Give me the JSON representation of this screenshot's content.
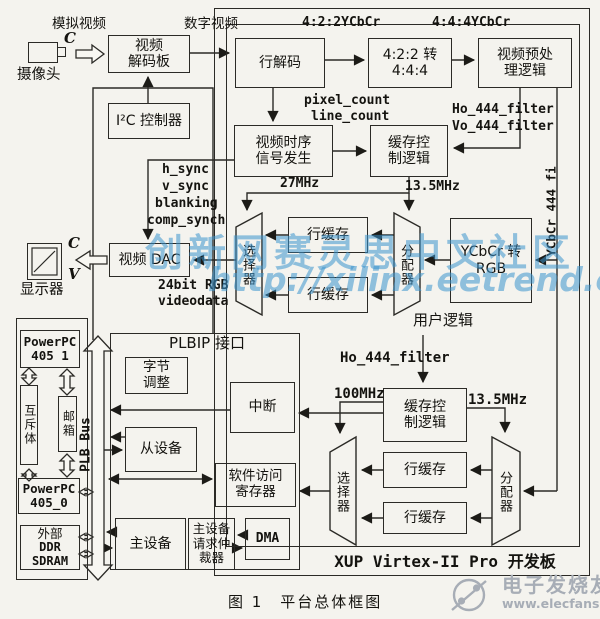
{
  "peripherals": {
    "camera_label": "摄像头",
    "analog_video": "模拟视频",
    "cam_c": "C",
    "decoder_l1": "视频",
    "decoder_l2": "解码板",
    "digital_video": "数字视频",
    "i2c": "I²C 控制器",
    "dac": "视频 DAC",
    "display": "显示器",
    "disp_c": "C",
    "disp_v": "V"
  },
  "signals": {
    "ycbcr422": "4:2:2YCbCr",
    "ycbcr444": "4:4:4YCbCr",
    "pixel_count": "pixel_count",
    "line_count": "line_count",
    "ho444_u": "Ho_444_filter",
    "vo444": "Vo_444_filter",
    "mhz27": "27MHz",
    "mhz135_u": "13.5MHz",
    "hsync": "h_sync",
    "vsync": "v_sync",
    "blanking": "blanking",
    "compsynch": "comp_synch",
    "rgb24": "24bit RGB",
    "videodata": "videodata",
    "ycbcr444fi": "YCbCr 444 fi",
    "ho444_l": "Ho_444_filter",
    "mhz100": "100MHz",
    "mhz135_l": "13.5MHz",
    "plb_bus": "PLB Bus"
  },
  "fpga": {
    "line_decode": "行解码",
    "conv_l1": "4:2:2 转",
    "conv_l2": "4:4:4",
    "preproc_l1": "视频预处",
    "preproc_l2": "理逻辑",
    "timing_l1": "视频时序",
    "timing_l2": "信号发生",
    "bufctl_l1": "缓存控",
    "bufctl_l2": "制逻辑",
    "line_buffer": "行缓存",
    "selector": "选择器",
    "distributor": "分配器",
    "ycbcr2rgb_l1": "YCbCr 转",
    "ycbcr2rgb_l2": "RGB",
    "user_logic": "用户逻辑",
    "board_label": "XUP Virtex-II Pro 开发板"
  },
  "plbip": {
    "title": "PLBIP 接口",
    "byte_adjust_l1": "字节",
    "byte_adjust_l2": "调整",
    "interrupt": "中断",
    "slave": "从设备",
    "swreg_l1": "软件访问",
    "swreg_l2": "寄存器",
    "master": "主设备",
    "arbiter_l1": "主设备",
    "arbiter_l2": "请求仲",
    "arbiter_l3": "裁器",
    "dma": "DMA"
  },
  "ppc": {
    "ppc1_l1": "PowerPC",
    "ppc1_l2": "405 1",
    "mutex": "互斥体",
    "mailbox": "邮箱",
    "ppc0_l1": "PowerPC",
    "ppc0_l2": "405_0",
    "ddr_l1": "外部",
    "ddr_l2": "DDR",
    "ddr_l3": "SDRAM"
  },
  "watermark": {
    "line1": "创新网赛灵思中文社区",
    "line2": "http://xilinx.eetrend.com"
  },
  "footer": {
    "caption": "图 1　平台总体框图",
    "brand": "电子发烧友",
    "brand_url": "www.elecfans.com"
  }
}
